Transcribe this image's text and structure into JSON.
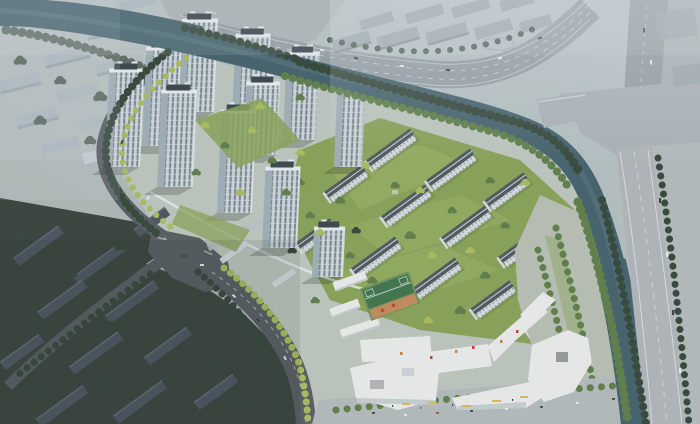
{
  "image": {
    "title": "Aerial rendering of a riverside residential development",
    "type": "architectural bird's-eye visualization",
    "description": "Bird's-eye render of a new housing estate: a cluster of high-rise towers on the west, rows of mid-rise apartment slabs with green courtyards in the center, an angular white retail street along the south, a tree-lined canal and riverside avenue on the east, a city highway and warehouse district to the north, and an existing dark neighborhood to the southwest."
  },
  "scene": {
    "labels": {
      "background_city": "Hazy background city blocks",
      "lake": "River water at top-left",
      "highway": "City highway with traffic",
      "warehouses": "Industrial warehouse district",
      "ne_intersection": "North-east road intersection and bridge",
      "canal": "Tree-lined canal",
      "riverside_road": "Riverside avenue",
      "east_strip": "Tree belt east of riverside avenue",
      "site_ground": "Development site ground",
      "towers": "High-rise residential tower cluster",
      "tower": "Residential tower",
      "courtyards": "Landscaped tower courtyards",
      "midrise": "Mid-rise apartment slabs with lawns",
      "slab": "Apartment slab",
      "promenade": "Riverfront promenade with tree rows",
      "commercial": "Angular retail street complex",
      "court": "Basketball court",
      "playground": "Children's playground",
      "south_plaza": "South sidewalk plaza with street trees",
      "old_neighborhood": "Existing dark-roofed neighborhood",
      "roads": "Perimeter roads and main intersection",
      "traffic": "Cars on roads",
      "haze": "Atmospheric haze"
    },
    "counts": {
      "towers": 11,
      "apartment_slabs": 12,
      "old_blocks": 11,
      "warehouse_blocks": 11
    }
  },
  "colors": {
    "sky_haze": "#b9c3c9",
    "sky_low": "#a6b0ab",
    "bg_city": "#a6b1ba",
    "bg_city_shade": "#8c99a5",
    "water": "#43606b",
    "water_light": "#6c888e",
    "highway": "#949da3",
    "plaza": "#a9b1b6",
    "road_dark": "#565c60",
    "road_light": "#aeb4b7",
    "lane": "#eef2f4",
    "warehouse": "#9ba5ac",
    "warehouse_shade": "#848f98",
    "tower_face": "#cbd3d8",
    "tower_side": "#9fadb6",
    "tower_window": "#66777f",
    "tower_roof": "#39444b",
    "parapet": "#e6ebee",
    "midrise_face": "#d4dadd",
    "midrise_roof": "#4d575c",
    "ridge": "#cdd4d7",
    "lawn": "#87a156",
    "lawn_light": "#9ab264",
    "tree": "#5d7d47",
    "tree_bright": "#a9ba5e",
    "tree_dark": "#344539",
    "commercial_roof": "#e8eae9",
    "commercial_shade": "#c6cccd",
    "storefront": "#4e5356",
    "signage": "#d6b85c",
    "court": "#3f7249",
    "court_edge": "#6e8f5a",
    "playground": "#c08a5a",
    "play_red": "#b8452f",
    "park_ground": "#b7bdb3",
    "promenade": "#b3b9bb",
    "old_block": "#4a545e",
    "old_base": "#37423c",
    "car_white": "#e8eaea",
    "car_dark": "#3a4147",
    "shadow": "#263129"
  }
}
